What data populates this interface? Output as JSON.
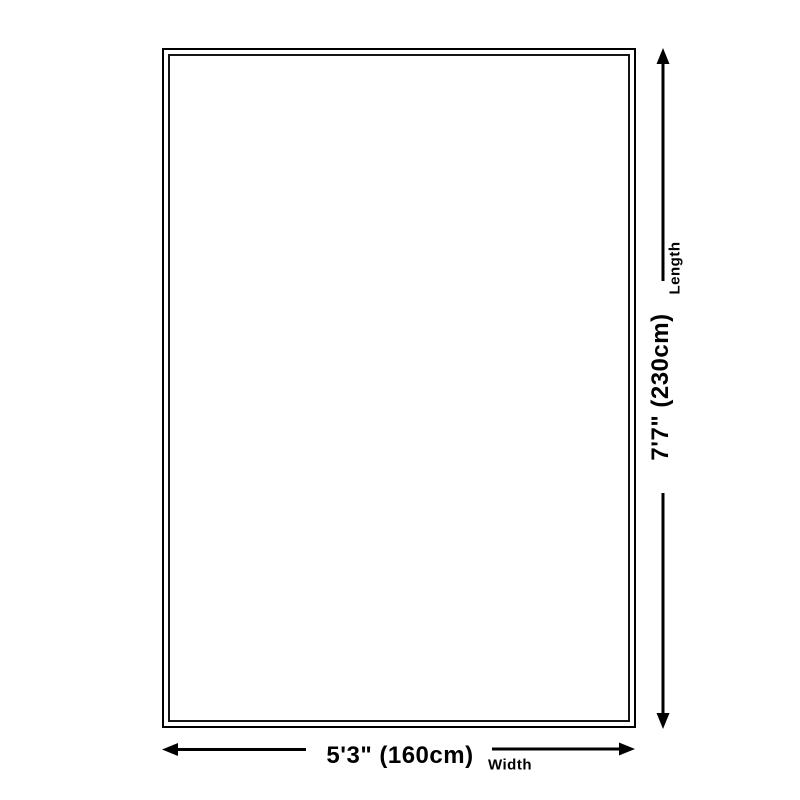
{
  "page": {
    "background_color": "#ffffff"
  },
  "diagram": {
    "type": "product-dimensions",
    "line_color": "#000000",
    "rug": {
      "outer_border_color": "#000000",
      "inner_border_color": "#141414",
      "fill_color": "#ffffff"
    },
    "length_axis": {
      "label": "Length",
      "value": "7'7\" (230cm)"
    },
    "width_axis": {
      "label": "Width",
      "value": "5'3\" (160cm)"
    }
  }
}
